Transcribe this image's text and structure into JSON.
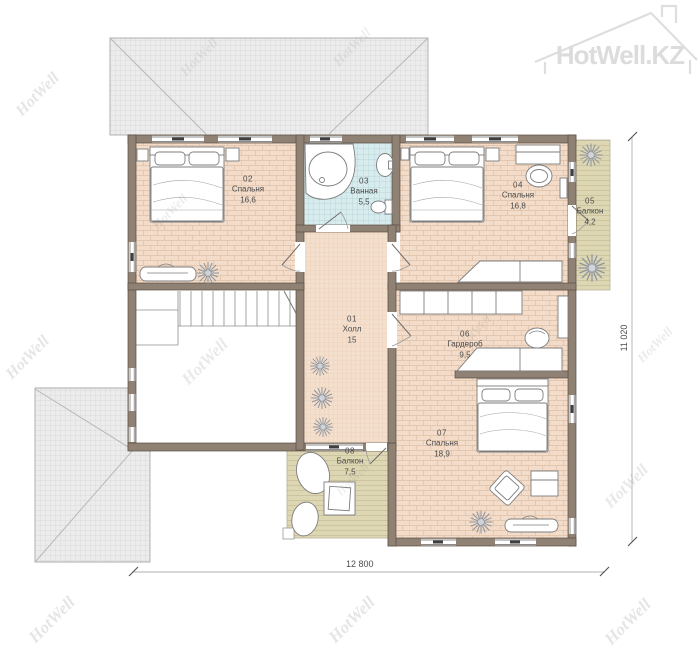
{
  "brand": {
    "watermark": "HotWell",
    "logo": "HotWell.KZ"
  },
  "plan": {
    "rooms": [
      {
        "id": "01",
        "name": "Холл",
        "area": "15"
      },
      {
        "id": "02",
        "name": "Спальня",
        "area": "16,6"
      },
      {
        "id": "03",
        "name": "Ванная",
        "area": "5,5"
      },
      {
        "id": "04",
        "name": "Спальня",
        "area": "16,8"
      },
      {
        "id": "05",
        "name": "Балкон",
        "area": "4,2"
      },
      {
        "id": "06",
        "name": "Гардероб",
        "area": "9,5"
      },
      {
        "id": "07",
        "name": "Спальня",
        "area": "18,9"
      },
      {
        "id": "08",
        "name": "Балкон",
        "area": "7,5"
      }
    ],
    "dimensions": {
      "width": "12 800",
      "height": "11 020"
    }
  },
  "colors": {
    "wall": "#8f8173",
    "wall_edge": "#5a4f45",
    "bedroom_floor": "#f3dcc9",
    "bathroom_floor": "#d8ecee",
    "balcony_floor": "#ded7b4",
    "hall_floor": "#f4dfcd",
    "roof": "#ececec",
    "furniture_line": "#7d7d7d",
    "watermark_gray": "#dcdcdc"
  }
}
